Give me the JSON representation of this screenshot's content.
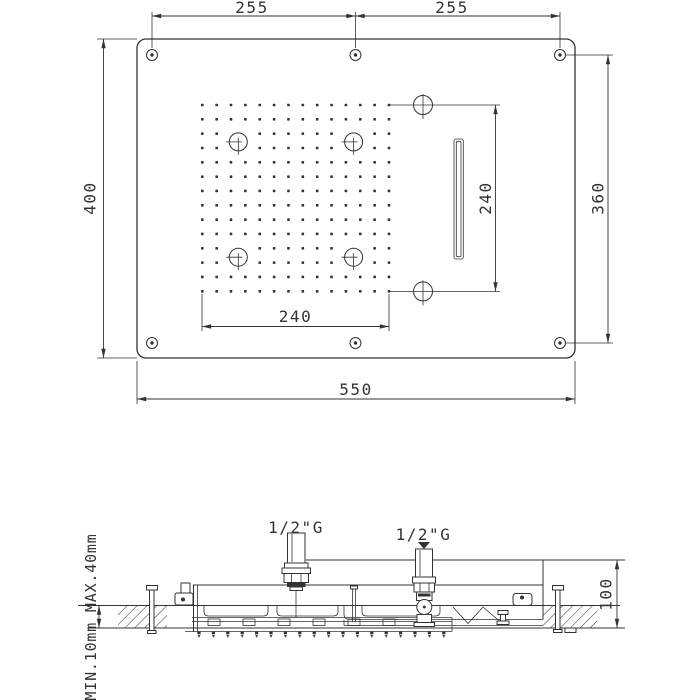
{
  "colors": {
    "line": "#333333",
    "background": "#ffffff"
  },
  "top_view": {
    "hole_pitch_left": "255",
    "hole_pitch_right": "255",
    "panel_height": "400",
    "panel_width": "550",
    "spray_field_width": "240",
    "spray_field_height": "240",
    "mount_holes_vertical_pitch": "360"
  },
  "section_view": {
    "inlet_left_label": "1/2\"G",
    "inlet_right_label": "1/2\"G",
    "recess_depth": "100",
    "ceiling_thickness_note": "MIN.10mm MAX.40mm"
  },
  "spray_grid": {
    "cols": 14,
    "rows": 14,
    "x0": 202.3,
    "y0": 105.0,
    "dx": 14.36,
    "dy": 14.33,
    "dot": 2.6,
    "jets": [
      {
        "cx": 238.3,
        "cy": 141.9
      },
      {
        "cx": 353.6,
        "cy": 141.9
      },
      {
        "cx": 238.3,
        "cy": 257.2
      },
      {
        "cx": 353.6,
        "cy": 257.2
      }
    ],
    "side_holes": [
      {
        "cx": 423,
        "cy": 105
      },
      {
        "cx": 423,
        "cy": 291.4
      }
    ]
  },
  "nozzle_row": {
    "x0": 199.0,
    "step": 14.4,
    "count": 18,
    "y": 631.5
  }
}
